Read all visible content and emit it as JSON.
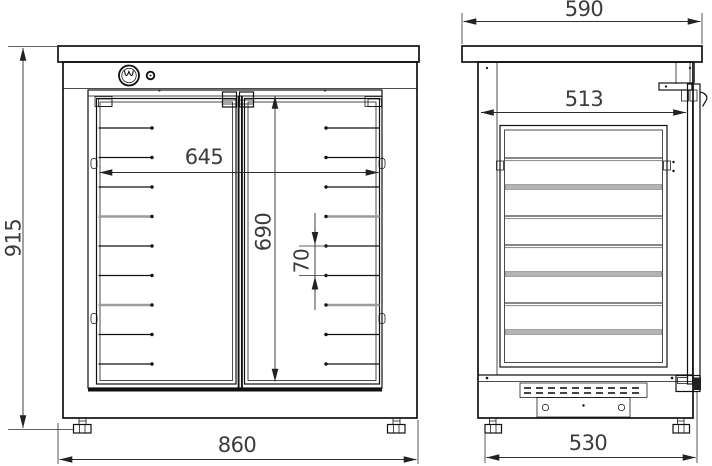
{
  "dims": {
    "overall_height": "915",
    "overall_width": "860",
    "opening_width": "645",
    "opening_height": "690",
    "shelf_spacing": "70",
    "overall_depth": "590",
    "interior_depth": "513",
    "base_depth": "530"
  },
  "structure": {
    "front_rail_count": 9,
    "front_rail_top_y": 128,
    "front_rail_pitch": 29.5,
    "side_shelf_count": 7,
    "side_shelf_top_y": 158,
    "side_shelf_pitch": 29
  },
  "colors": {
    "line": "#111111",
    "dimension": "#3c3c3c",
    "shelf_gray": "#b4b4b4"
  }
}
